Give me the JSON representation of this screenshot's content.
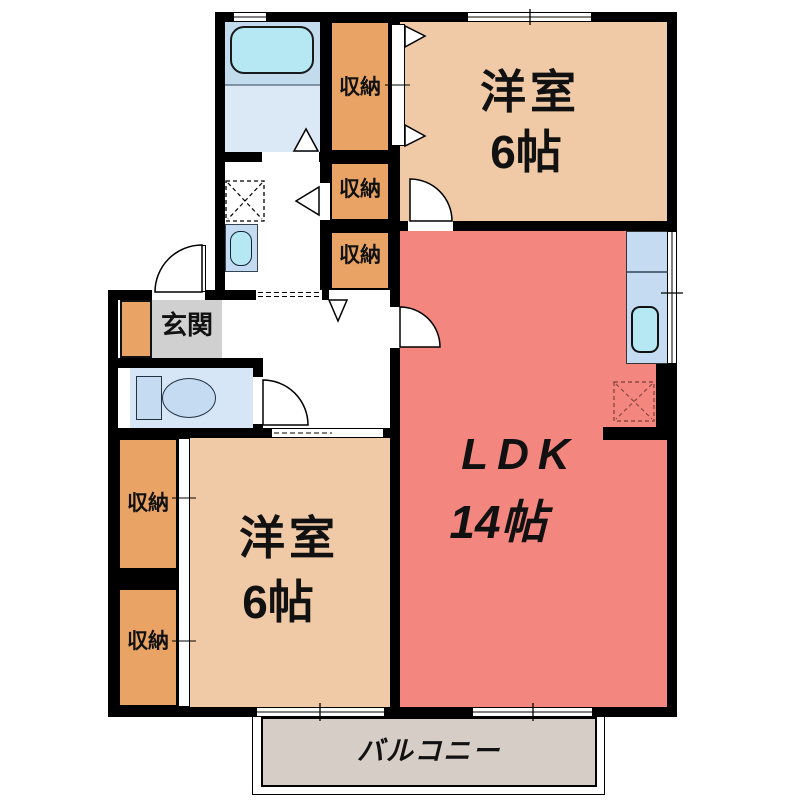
{
  "rooms": {
    "bedroom_top": {
      "label": "洋室",
      "size": "6帖"
    },
    "ldk": {
      "label": "LDK",
      "size": "14帖"
    },
    "bedroom_bottom": {
      "label": "洋室",
      "size": "6帖"
    },
    "entrance": {
      "label": "玄関"
    },
    "balcony": {
      "label": "バルコニー"
    }
  },
  "closets": [
    {
      "label": "収納"
    },
    {
      "label": "収納"
    },
    {
      "label": "収納"
    },
    {
      "label": "収納"
    },
    {
      "label": "収納"
    }
  ],
  "fixtures": {
    "bathtub": "rounded-rect",
    "washbasin": "rounded-rect-sink",
    "washing_machine_space": "dashed-x-square",
    "toilet": "tank-and-bowl",
    "kitchen_counter": "rect-with-sink",
    "refrigerator_space": "dashed-x-square"
  },
  "colors": {
    "wall": "#000000",
    "bedroom": "#F0CAA6",
    "ldk": "#F3867E",
    "closet": "#E9A364",
    "entrance_floor": "#D0D0D0",
    "balcony_floor": "#D6CEC6",
    "bath_upper": "#C2DCEE",
    "bath_lower": "#DBE8F6",
    "toilet_room": "#D7E6F6",
    "water_fixture": "#C5DBF2",
    "sink_cyan": "#B5E8F2",
    "fridge_dash": "#8A4A42"
  }
}
